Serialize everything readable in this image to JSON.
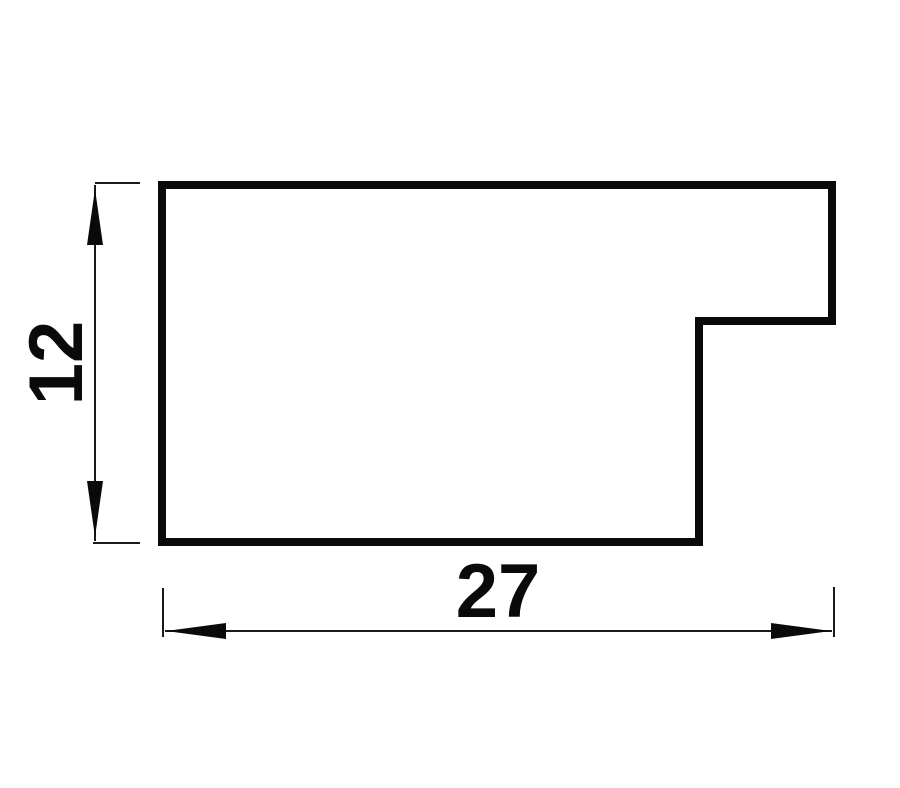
{
  "page": {
    "background": "#ffffff"
  },
  "drawing": {
    "kind": "technical-cross-section-profile",
    "outline": {
      "description": "stepped rectangular moulding profile with notch cut from lower-right",
      "points": "162,185 832,185 832,321 699,321 699,542 162,542",
      "stroke_color": "#0a0a0a",
      "stroke_width": "8"
    },
    "dimensions": {
      "height": {
        "value": "12",
        "orientation": "vertical"
      },
      "width": {
        "value": "27",
        "orientation": "horizontal"
      }
    },
    "dimension_style": {
      "line_color": "#1a1a1a",
      "line_width": "2"
    }
  }
}
